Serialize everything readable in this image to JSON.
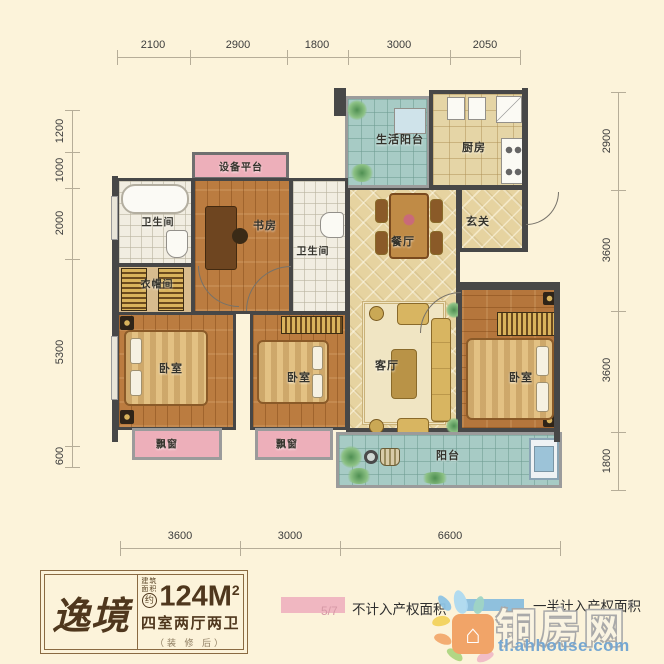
{
  "plan": {
    "dimensions": {
      "top": [
        "2100",
        "2900",
        "1800",
        "3000",
        "2050"
      ],
      "left": [
        "1200",
        "1000",
        "2000",
        "5300",
        "600"
      ],
      "right": [
        "2900",
        "3600",
        "3600",
        "1800"
      ],
      "bottom": [
        "3600",
        "3000",
        "6600"
      ]
    },
    "rooms": {
      "life_balcony": "生活阳台",
      "kitchen": "厨房",
      "equipment_platform": "设备平台",
      "bathroom_1": "卫生间",
      "study": "书房",
      "bathroom_2": "卫生间",
      "entry": "玄关",
      "dining": "餐厅",
      "cloakroom": "衣帽间",
      "bedroom_1": "卧室",
      "bedroom_2": "卧室",
      "living_room": "客厅",
      "master_bedroom": "卧室",
      "bay_window_1": "飘窗",
      "bay_window_2": "飘窗",
      "balcony": "阳台"
    }
  },
  "info_card": {
    "name": "逸境",
    "area_prefix_line1": "建筑",
    "area_prefix_line2": "面积",
    "area_approx": "约",
    "area_value": "124M",
    "area_exponent": "2",
    "layout": "四室两厅两卫",
    "note": "（装 修 后）"
  },
  "legend": {
    "page_indicator": "5/7",
    "not_counted_label": "不计入产权面积",
    "half_counted_label": "一半计入产权面积",
    "not_counted_color": "#f0b7c1",
    "half_counted_color": "#8fc0dd"
  },
  "watermark": {
    "site_name": "铜房网",
    "registered": "®",
    "site_url": "tl.ahhouse.com",
    "house_icon_glyph": "⌂"
  },
  "colors": {
    "background": "#fcf3da",
    "wall": "#474747",
    "wood_floor": "#bb7c40",
    "diamond_tile": "#e6d3a0",
    "balcony_tile": "#a7cbc5",
    "pink_area": "#edafba"
  }
}
